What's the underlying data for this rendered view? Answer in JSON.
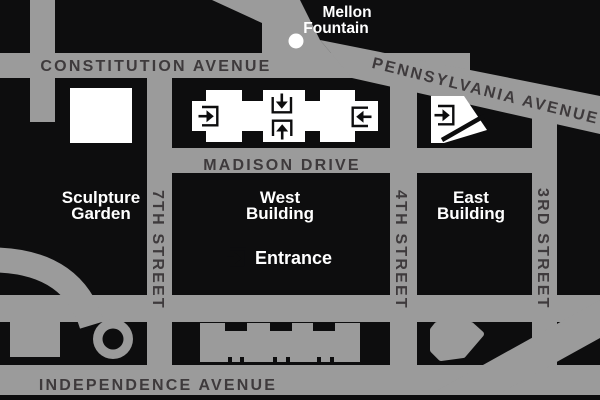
{
  "colors": {
    "street_gray": "#9b9b9b",
    "block_black": "#0d0d0e",
    "label_dark": "#3e3a3c",
    "label_white": "#ffffff"
  },
  "streets": {
    "constitution": "CONSTITUTION AVENUE",
    "madison": "MADISON DRIVE",
    "pennsylvania": "PENNSYLVANIA AVENUE",
    "independence": "INDEPENDENCE AVENUE",
    "seventh": "7TH STREET",
    "fourth": "4TH STREET",
    "third": "3RD STREET"
  },
  "places": {
    "mellon": {
      "line1": "Mellon",
      "line2": "Fountain"
    },
    "sculpture_garden": {
      "line1": "Sculpture",
      "line2": "Garden"
    },
    "west_building": {
      "line1": "West",
      "line2": "Building"
    },
    "east_building": {
      "line1": "East",
      "line2": "Building"
    },
    "entrance": "Entrance"
  },
  "icons": {
    "entrance_arrow": "arrow-into-bracket"
  }
}
